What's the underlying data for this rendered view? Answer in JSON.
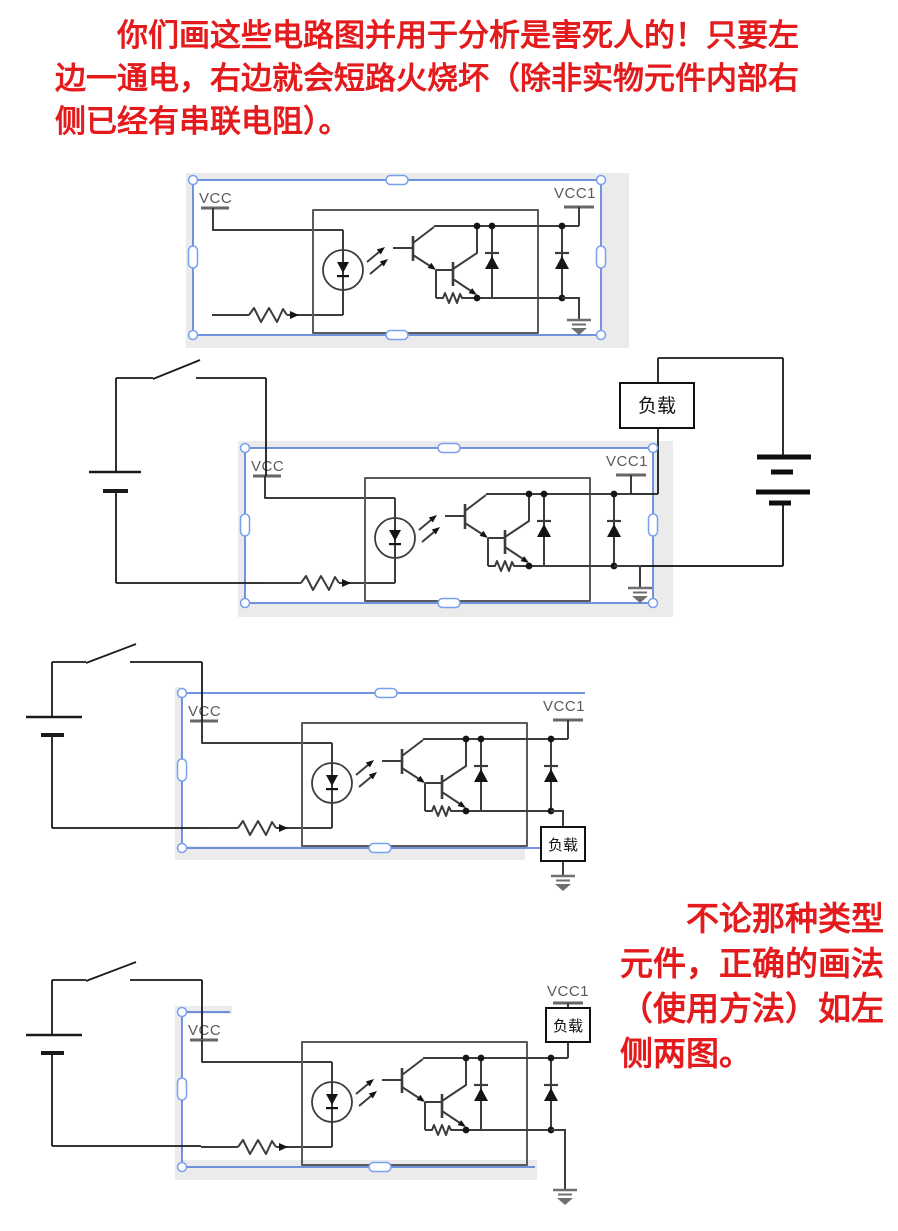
{
  "notes": {
    "top": "　　你们画这些电路图并用于分析是害死人的！只要左\n边一通电，右边就会短路火烧坏（除非实物元件内部右\n侧已经有串联电阻）。",
    "side": "　　不论那种类型\n元件，正确的画法\n（使用方法）如左\n侧两图。"
  },
  "labels": {
    "vcc": "VCC",
    "vcc1": "VCC1",
    "load": "负载"
  },
  "colors": {
    "note_red": "#e41b1d",
    "frame_blue": "#4472d9",
    "handle_blue": "#78a0f0",
    "shadow_grey": "#ebebeb",
    "wire_dark": "#3c3c3c",
    "external_wire": "#1a1a1a",
    "ic_label_grey": "#5a5a5a"
  }
}
